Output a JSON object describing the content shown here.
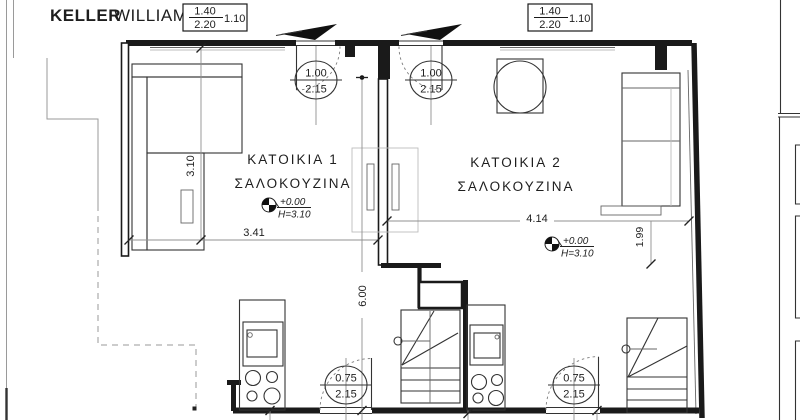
{
  "brand": {
    "name_bold": "KELLER",
    "name_light": "WILLIAMS"
  },
  "header_boxes": [
    {
      "numerator": "1.40",
      "denominator": "2.20",
      "adjacent": "1.10"
    },
    {
      "numerator": "1.40",
      "denominator": "2.20",
      "adjacent": "1.10"
    }
  ],
  "apartments": [
    {
      "name": "ΚΑΤΟΙΚΙΑ 1",
      "room": "ΣΑΛΟΚΟΥΖΙΝΑ",
      "level": "+0.00",
      "clear_height": "H=3.10",
      "width_dim": "3.41",
      "depth_dim": "3.10",
      "entry_door": {
        "width": "1.00",
        "height": "2.15"
      },
      "rear_door": {
        "width": "0.75",
        "height": "2.15"
      }
    },
    {
      "name": "ΚΑΤΟΙΚΙΑ 2",
      "room": "ΣΑΛΟΚΟΥΖΙΝΑ",
      "level": "+0.00",
      "clear_height": "H=3.10",
      "width_dim": "4.14",
      "depth_dim": "1.99",
      "entry_door": {
        "width": "1.00",
        "height": "2.15"
      },
      "rear_door": {
        "width": "0.75",
        "height": "2.15"
      }
    }
  ],
  "overall_dims": {
    "total_depth": "6.00"
  },
  "colors": {
    "wall": "#1a1a1a",
    "dimension_line": "#909090",
    "text": "#1e1e1e",
    "logo_dark": "#4d4d4d",
    "logo_light": "#b3b3b3"
  }
}
